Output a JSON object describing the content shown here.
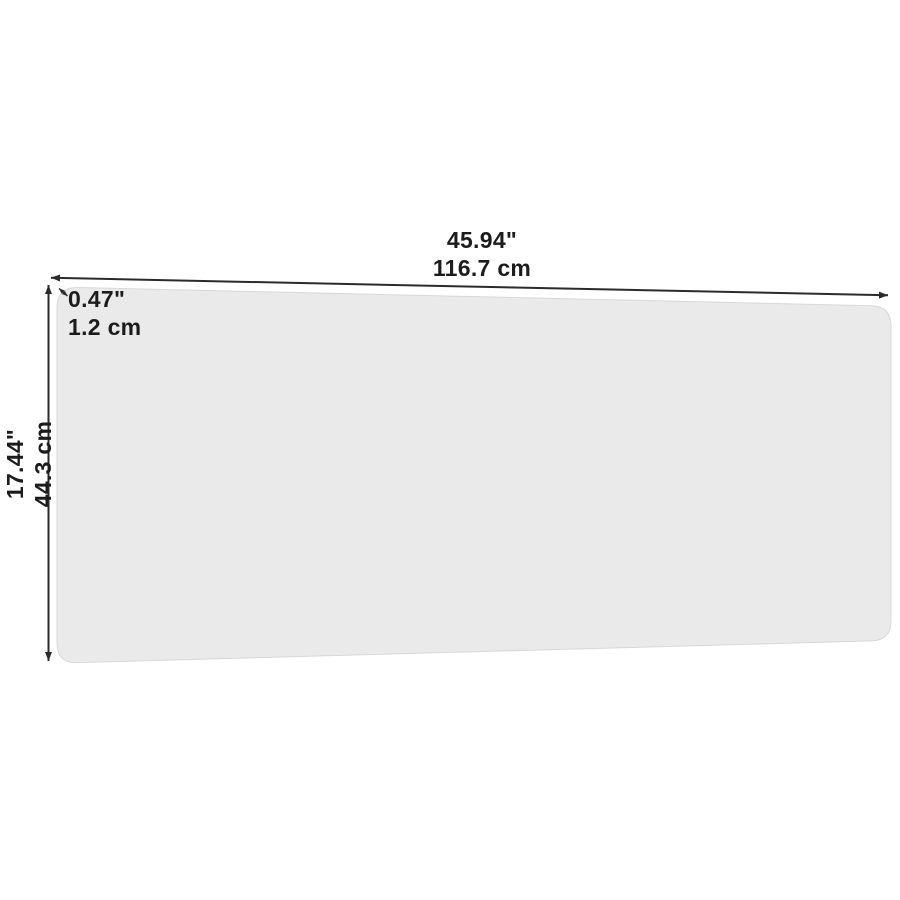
{
  "diagram": {
    "background_color": "#ffffff",
    "panel_fill": "#eaeaea",
    "panel_edge_color": "#d8d8d8",
    "line_color": "#2b2b2b",
    "text_color": "#1c1c1c",
    "width_label": {
      "inches": "45.94\"",
      "cm": "116.7 cm"
    },
    "height_label": {
      "inches": "17.44\"",
      "cm": "44.3 cm"
    },
    "thickness_label": {
      "inches": "0.47\"",
      "cm": "1.2 cm"
    }
  }
}
